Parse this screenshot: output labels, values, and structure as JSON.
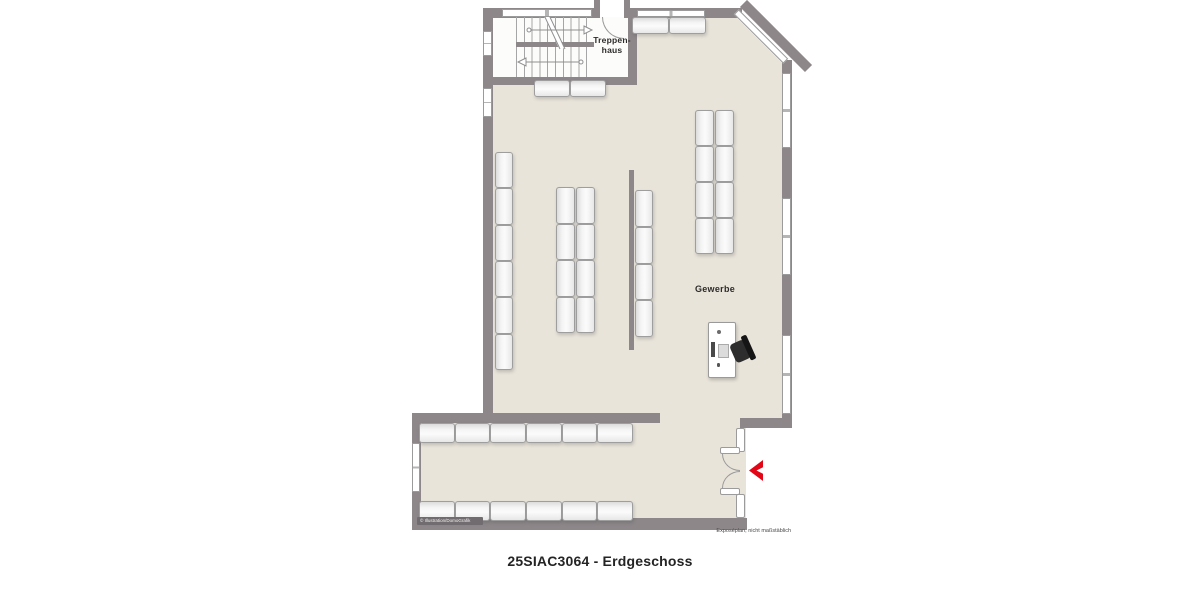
{
  "title": "25SIAC3064 - Erdgeschoss",
  "labels": {
    "stairwell_line1": "Treppen-",
    "stairwell_line2": "haus",
    "commercial": "Gewerbe"
  },
  "footnote": "Exposéplan, nicht maßstäblich",
  "watermark": "© Illustration/DomoGrafik",
  "icons": {
    "entrance_arrow": "red chevron pointing left at entrance door"
  },
  "colors": {
    "wall": "#8d878a",
    "floor": "#e9e4da",
    "stairwell_floor": "#fcfcfb",
    "accent_red": "#e30617",
    "shelf_fill": "#eeeeee",
    "shelf_border": "#9e9e9e"
  }
}
